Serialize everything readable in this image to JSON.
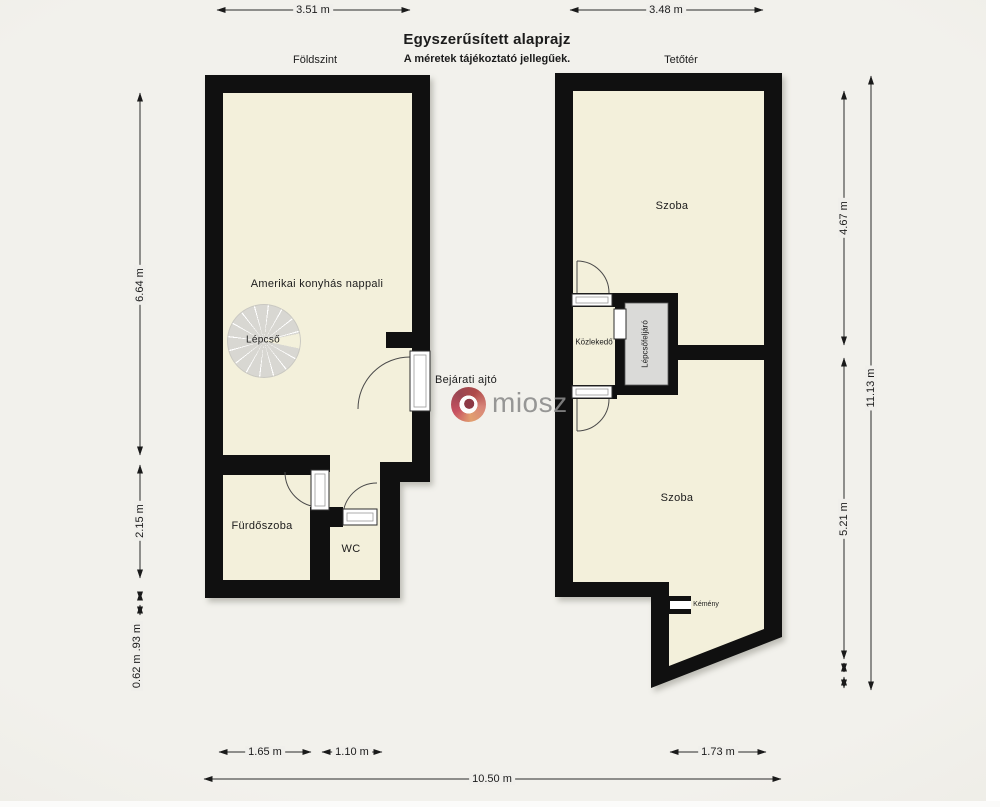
{
  "header": {
    "title": "Egyszerűsített alaprajz",
    "subtitle": "A méretek tájékoztató jellegűek.",
    "ground_label": "Földszint",
    "attic_label": "Tetőtér"
  },
  "ground_floor": {
    "living_room": "Amerikai konyhás nappali",
    "stairs": "Lépcső",
    "entrance_door": "Bejárati ajtó",
    "bathroom": "Fürdőszoba",
    "wc": "WC"
  },
  "attic": {
    "room_top": "Szoba",
    "hallway": "Közlekedő",
    "stair_landing": "Lépcsőfeljáró",
    "room_bottom": "Szoba",
    "chimney": "Kémény"
  },
  "dimensions": {
    "top_left_width": "3.51 m",
    "top_right_width": "3.48 m",
    "left_upper": "6.64 m",
    "left_lower": "2.15 m",
    "left_small": "0.62 m .93 m",
    "right_upper": "4.67 m",
    "right_total": "11.13 m",
    "right_lower": "5.21 m",
    "bottom_bathroom": "1.65 m",
    "bottom_wc": "1.10 m",
    "bottom_room": "1.73 m",
    "bottom_total": "10.50 m"
  },
  "watermark": {
    "text": "miosz"
  },
  "colors": {
    "background": "#f0efeb",
    "floor": "#f3f0db",
    "wall": "#101010",
    "stair": "#d8d7d2",
    "landing": "#dadad8",
    "dimension": "#2a2a2a",
    "text": "#1c1c1c",
    "logo_text": "#8a8a8a"
  }
}
